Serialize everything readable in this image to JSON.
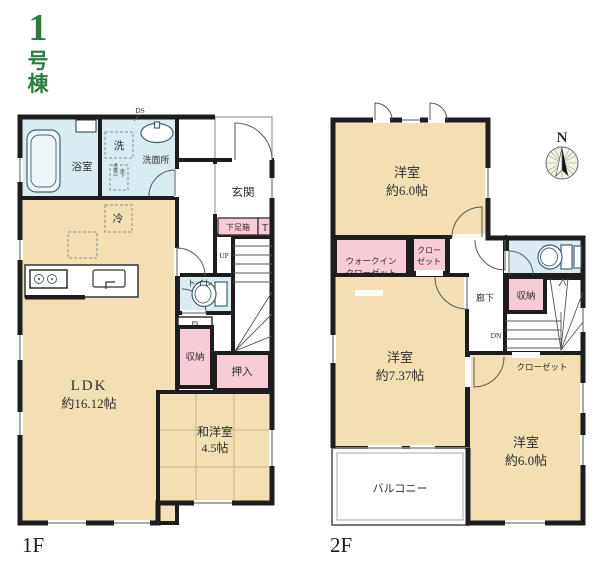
{
  "building_label": {
    "number": "1",
    "kanji1": "号",
    "kanji2": "棟"
  },
  "colors": {
    "accent_green": "#2b7d3f",
    "room_fill": "#f2e0b4",
    "wet_area_fill": "#daebf2",
    "closet_fill": "#f8ccd6",
    "wall": "#1d1d1d"
  },
  "floor1": {
    "label": "1F",
    "ds": "DS",
    "bath": "浴室",
    "washer": "洗",
    "washroom": "洗面所",
    "inspection_right": "床下",
    "inspection_left": "点検口",
    "entrance": "玄関",
    "shoebox": "下足箱",
    "shoebox_t": "T",
    "up": "UP",
    "toilet": "トイレ",
    "ps": "PS",
    "storage": "収納",
    "oshiire": "押入",
    "fridge": "冷",
    "ldk_name": "LDK",
    "ldk_size": "約16.12帖",
    "tatami_name": "和洋室",
    "tatami_size": "4.5帖"
  },
  "floor2": {
    "label": "2F",
    "compass_n": "N",
    "bedroom_n_name": "洋室",
    "bedroom_n_size": "約6.0帖",
    "wic_line1": "ウォークイン",
    "wic_line2": "クローゼット",
    "closet_small_line1": "クロー",
    "closet_small_line2": "ゼット",
    "hallway": "廊下",
    "storage": "収納",
    "dn": "DN",
    "closet_bottom": "クローゼット",
    "bedroom_w_name": "洋室",
    "bedroom_w_size": "約7.37帖",
    "balcony": "バルコニー",
    "bedroom_se_name": "洋室",
    "bedroom_se_size": "約6.0帖"
  }
}
